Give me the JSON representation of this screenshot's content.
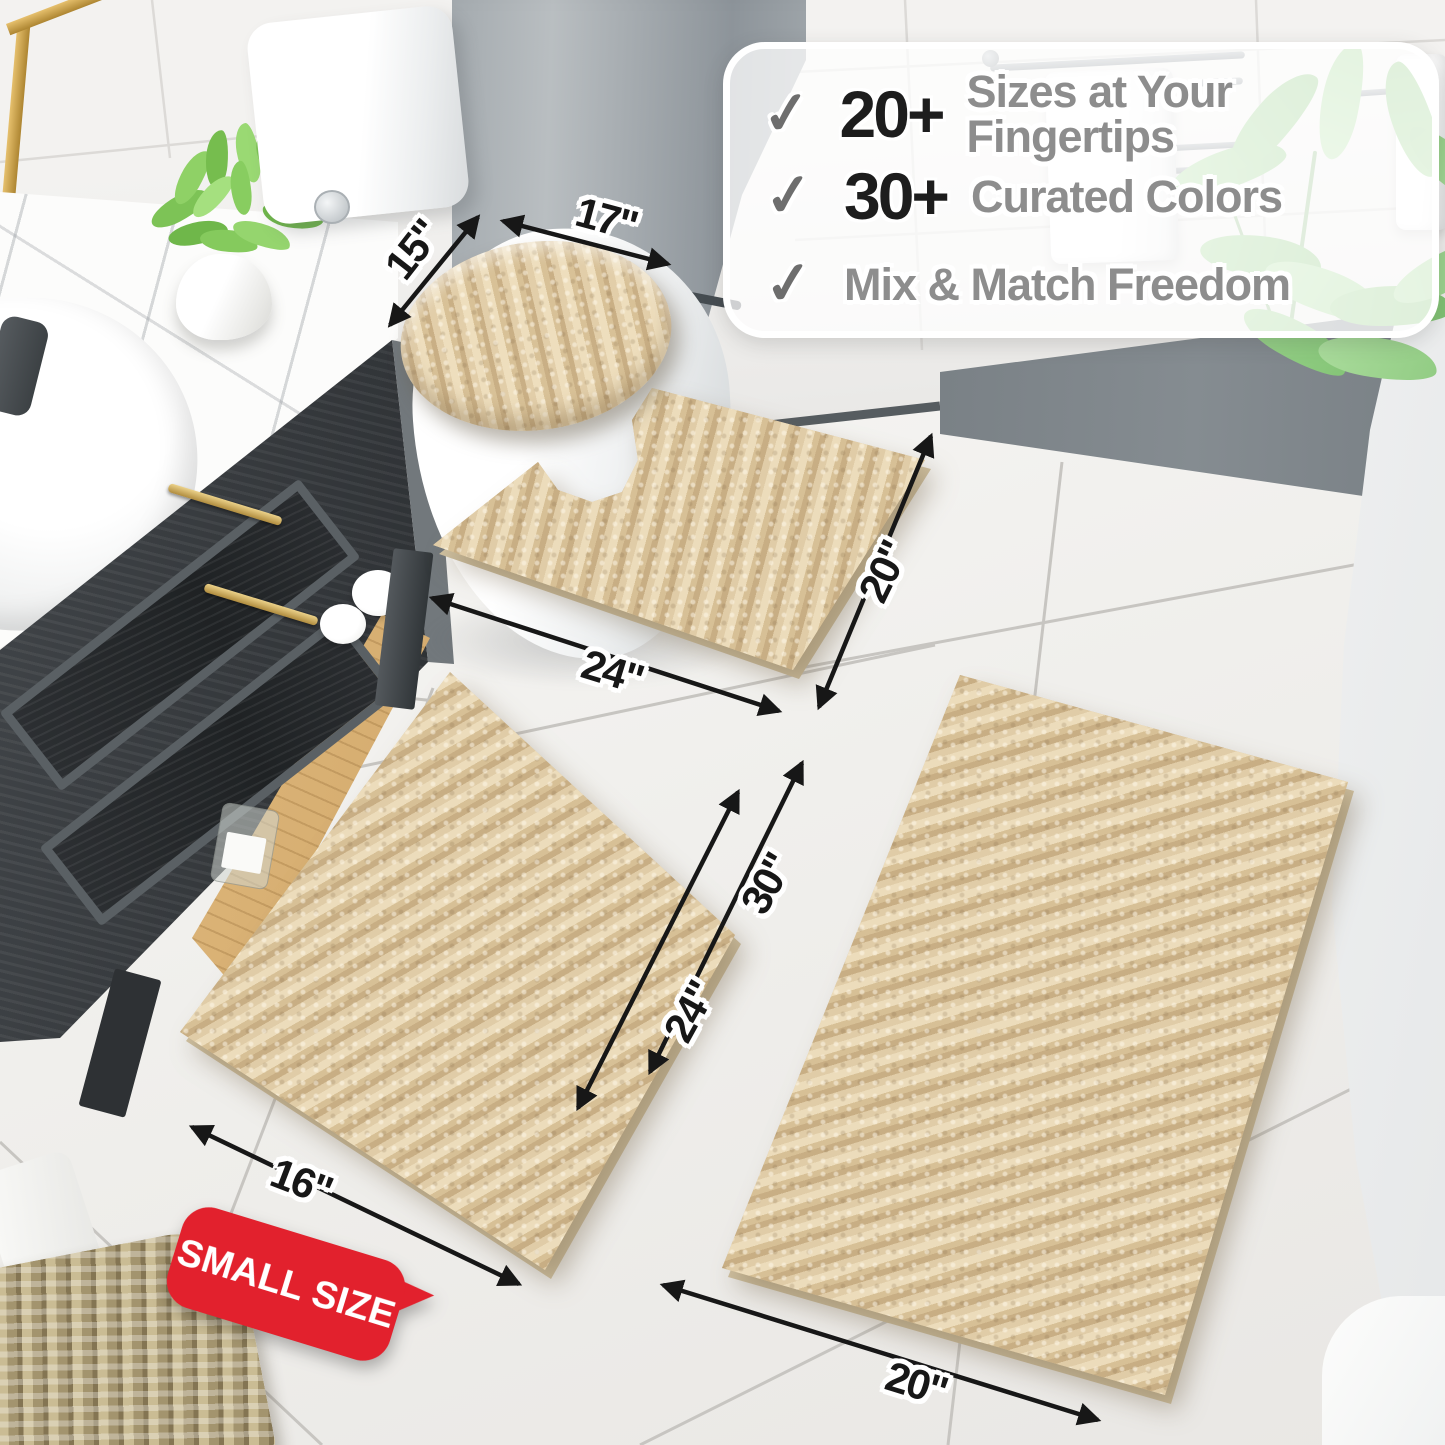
{
  "info_box": {
    "check_icon": "✓",
    "items": [
      {
        "stat": "20+",
        "label": "Sizes at Your Fingertips"
      },
      {
        "stat": "30+",
        "label": "Curated Colors"
      },
      {
        "stat": "",
        "label": "Mix & Match Freedom"
      }
    ]
  },
  "dimension_labels": {
    "lid_width": "17\"",
    "lid_depth": "15\"",
    "contour_width": "24\"",
    "contour_depth": "20\"",
    "small_rug_width": "16\"",
    "small_rug_length": "24\"",
    "large_rug_length": "30\"",
    "large_rug_width": "20\""
  },
  "badge": {
    "text": "SMALL SIZE"
  },
  "colors": {
    "badge_red": "#e2212d",
    "rug_beige": "#d9c29a",
    "dimension_ink": "#171717",
    "info_label_gray": "#8d8d8d",
    "info_stat_black": "#1d1d1d"
  }
}
